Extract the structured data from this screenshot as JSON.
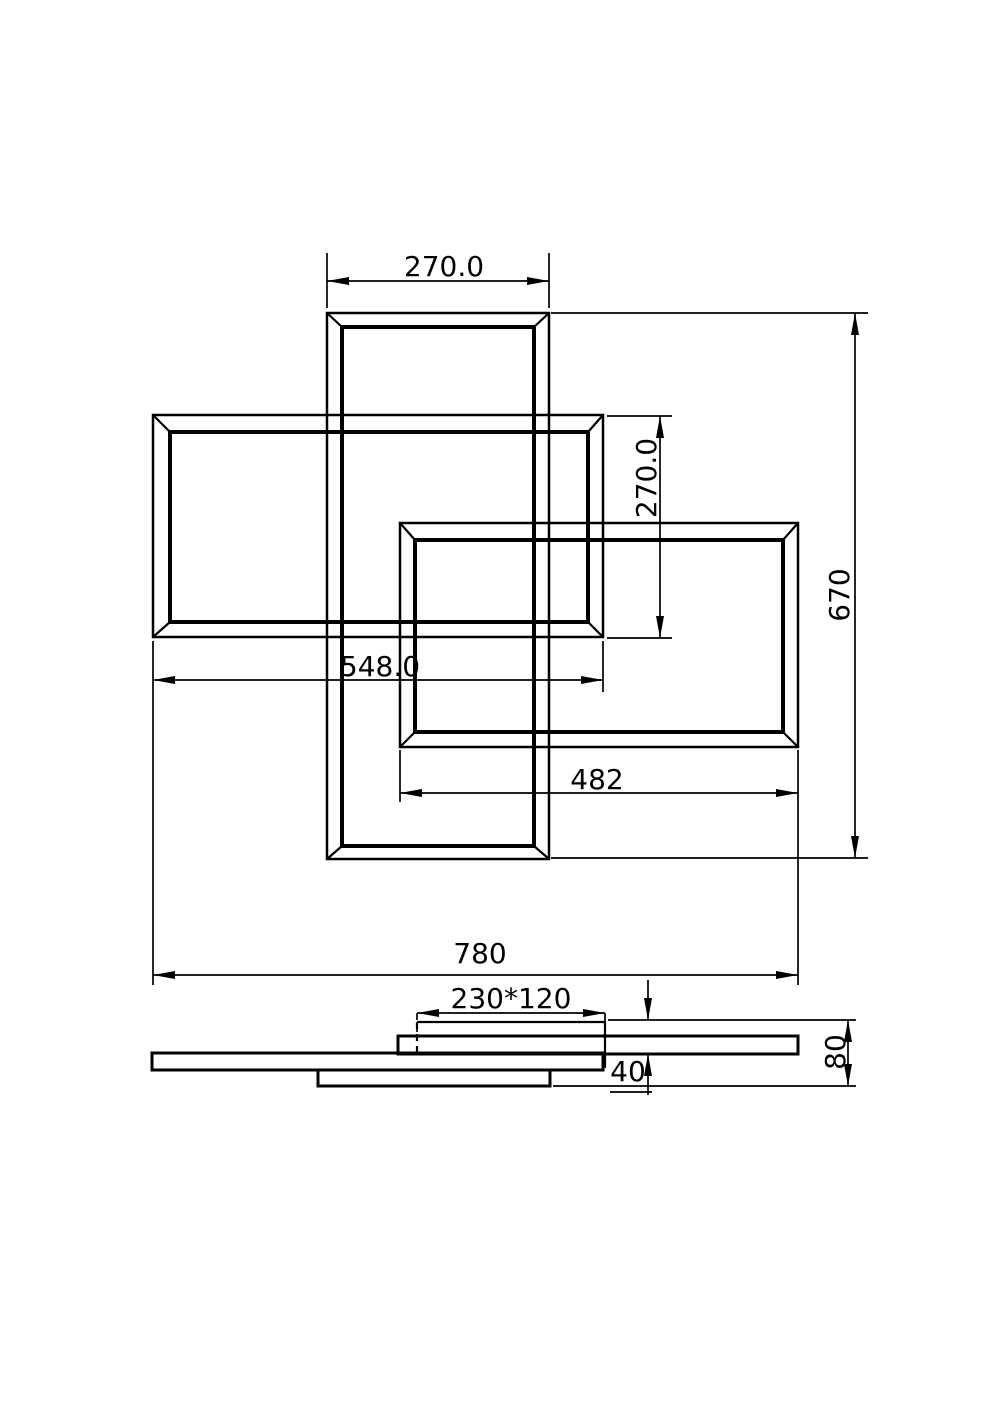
{
  "colors": {
    "ink": "#000000",
    "paper": "#ffffff"
  },
  "drawing": {
    "style": "black-and-white CAD dimension drawing, two views (plan view of three interlocking rectangular frames, side elevation view)"
  },
  "plan_view": {
    "dim_top_frame_width": "270.0",
    "dim_left_frame_height": "270.0",
    "dim_overall_height": "670",
    "dim_left_frame_width": "548.0",
    "dim_right_frame_width": "482",
    "dim_overall_width": "780"
  },
  "side_view": {
    "dim_canopy": "230*120",
    "dim_offset": "40",
    "dim_overall_depth": "80"
  }
}
